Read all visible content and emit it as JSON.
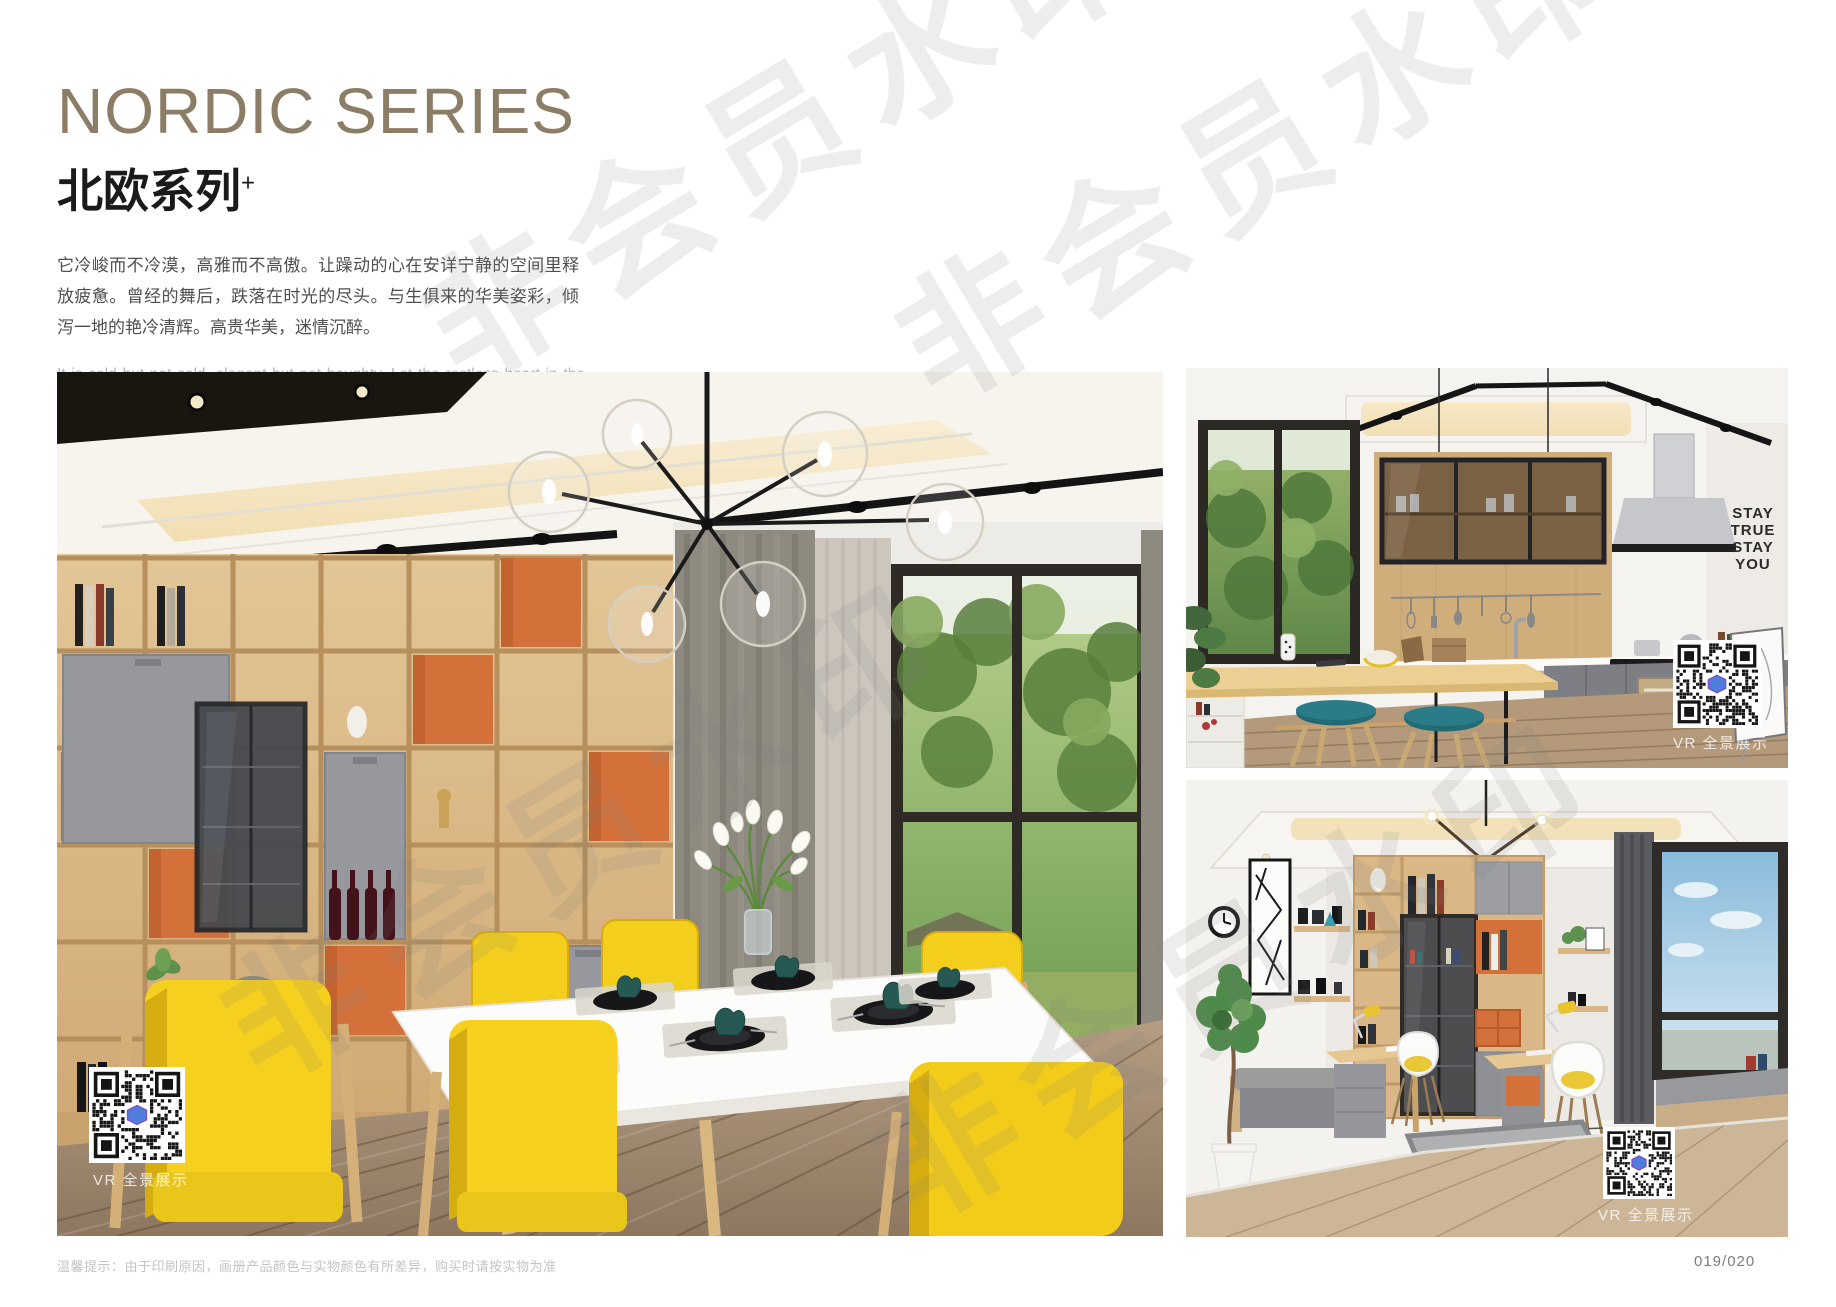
{
  "header": {
    "title_en": "NORDIC SERIES",
    "title_cn": "北欧系列",
    "title_superscript": "+",
    "intro_cn": "它冷峻而不冷漠，高雅而不高傲。让躁动的心在安详宁静的空间里释放疲惫。曾经的舞后，跌落在时光的尽头。与生俱来的华美姿彩，倾泻一地的艳冷清辉。高贵华美，迷情沉醉。",
    "intro_en": "It is cold but not cold, elegant but not haughty. Let the restless heart in the space of peace and tranquility release fatigue. Once the Queen of Dance, fall in the end of time. The natural beauty of the beautiful, pouring a land of cold and pure brilliance. Noble, beautiful, enchanted."
  },
  "photos": {
    "dining": {
      "vr_label": "VR 全景展示"
    },
    "kitchen": {
      "vr_label": "VR 全景展示",
      "wall_text": {
        "l1": "STAY",
        "l2": "TRUE",
        "l3": "STAY",
        "l4": "YOU"
      }
    },
    "study": {
      "vr_label": "VR 全景展示"
    }
  },
  "watermark": {
    "text": "非会员水印"
  },
  "footer": {
    "note": "温馨提示：由于印刷原因，画册产品颜色与实物颜色有所差异，购买时请按实物为准",
    "page_number": "019/020"
  },
  "colors": {
    "title_taupe": "#8c7d67",
    "accent_orange": "#d4713a",
    "chair_yellow": "#f5cf1c",
    "stool_teal": "#27707a",
    "wood": "#d8b684"
  }
}
